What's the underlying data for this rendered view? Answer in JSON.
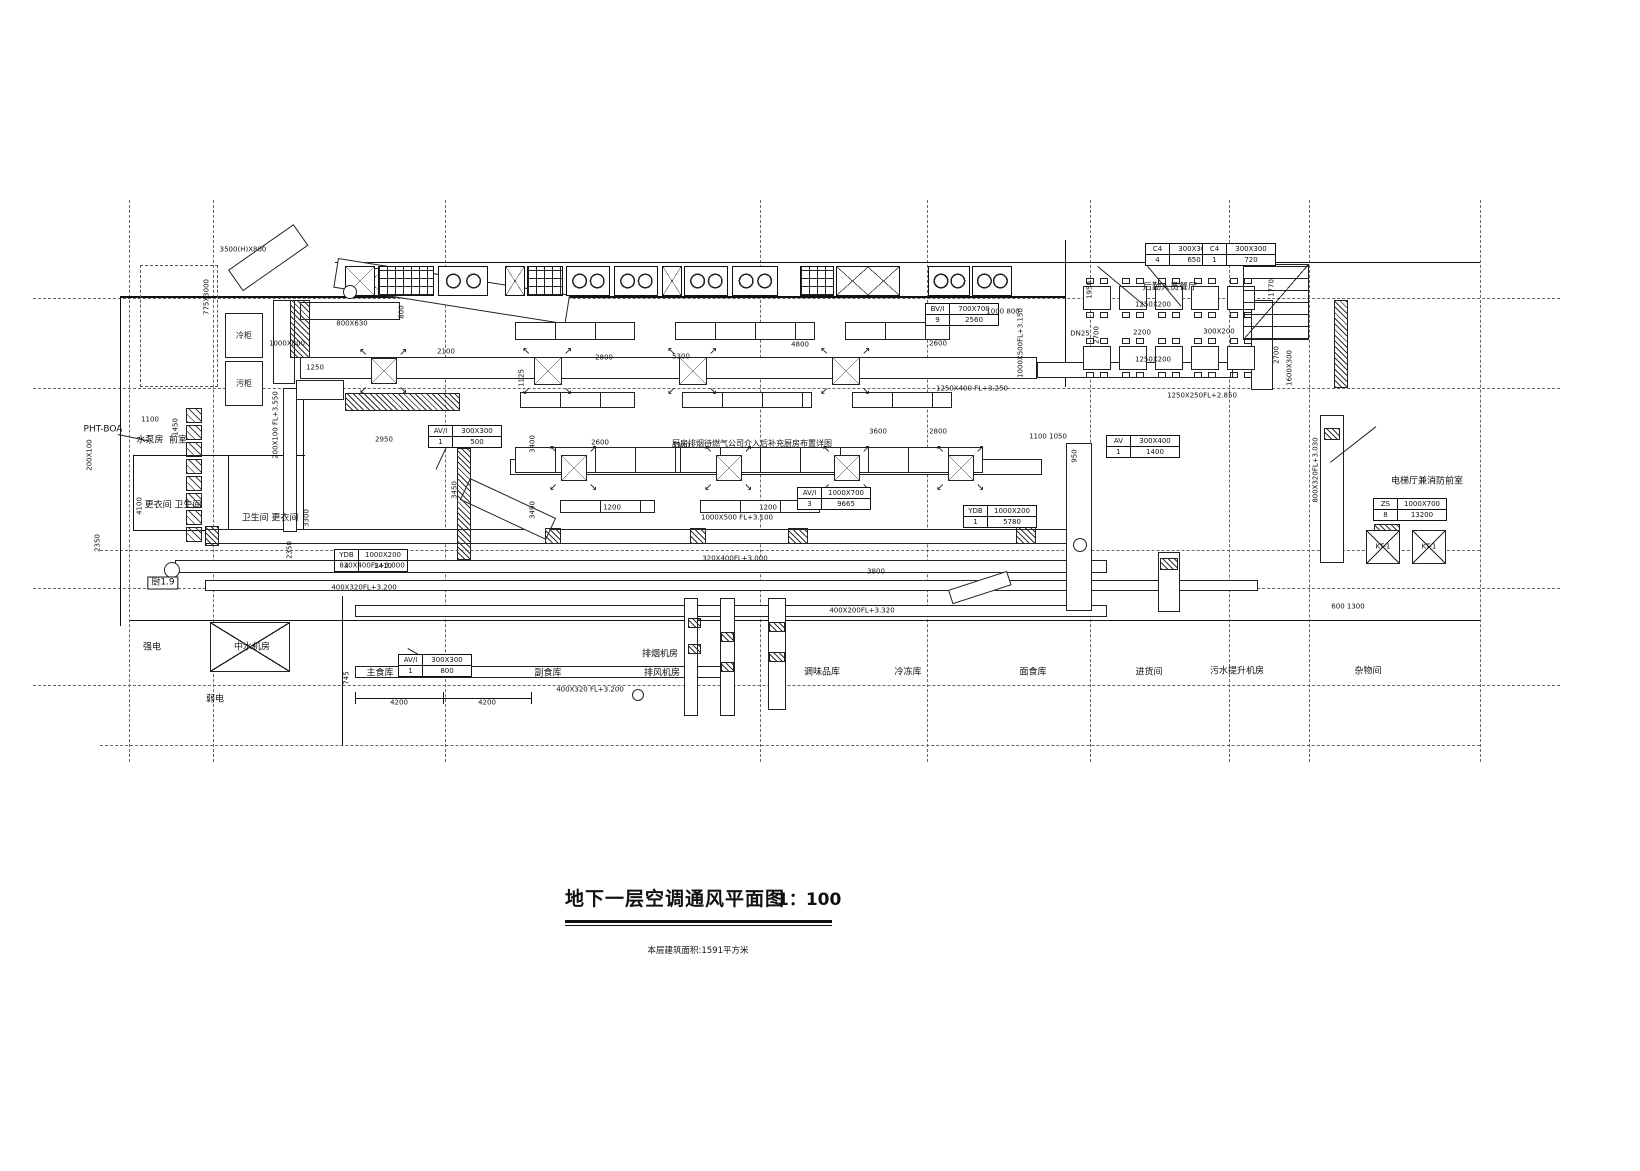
{
  "title_block": {
    "title": "地下一层空调通风平面图",
    "scale": "1：100",
    "note": "本层建筑面积:1591平方米"
  },
  "grid": {
    "v": [
      129,
      213,
      445,
      760,
      927,
      1090,
      1229,
      1309,
      1480
    ],
    "h": [
      {
        "y": 298,
        "x1": 33,
        "x2": 1560
      },
      {
        "y": 388,
        "x1": 33,
        "x2": 1560
      },
      {
        "y": 550,
        "x1": 100,
        "x2": 1480
      },
      {
        "y": 588,
        "x1": 33,
        "x2": 1560
      },
      {
        "y": 685,
        "x1": 33,
        "x2": 1560
      },
      {
        "y": 745,
        "x1": 100,
        "x2": 1480
      }
    ]
  },
  "walls": [
    {
      "x": 335,
      "y": 262,
      "w": 700,
      "h": 1
    },
    {
      "x": 1035,
      "y": 262,
      "w": 445,
      "h": 1
    },
    {
      "x": 1065,
      "y": 240,
      "w": 1,
      "h": 147
    },
    {
      "x": 120,
      "y": 296,
      "w": 945,
      "h": 2
    },
    {
      "x": 120,
      "y": 296,
      "w": 1,
      "h": 330
    },
    {
      "x": 130,
      "y": 620,
      "w": 1350,
      "h": 1
    },
    {
      "x": 342,
      "y": 596,
      "w": 1,
      "h": 149
    },
    {
      "x": 133,
      "y": 455,
      "w": 172,
      "h": 1
    },
    {
      "x": 133,
      "y": 530,
      "w": 172,
      "h": 1
    },
    {
      "x": 133,
      "y": 455,
      "w": 1,
      "h": 76
    },
    {
      "x": 228,
      "y": 455,
      "w": 1,
      "h": 76
    },
    {
      "x": 303,
      "y": 390,
      "w": 1,
      "h": 141
    },
    {
      "x": 355,
      "y": 698,
      "w": 176,
      "h": 1
    },
    {
      "x": 355,
      "y": 692,
      "w": 1,
      "h": 12
    },
    {
      "x": 443,
      "y": 692,
      "w": 1,
      "h": 12
    },
    {
      "x": 531,
      "y": 692,
      "w": 1,
      "h": 12
    }
  ],
  "ducts": {
    "h": [
      {
        "x": 300,
        "y": 357,
        "w": 737,
        "h": 22
      },
      {
        "x": 1037,
        "y": 362,
        "w": 196,
        "h": 16
      },
      {
        "x": 510,
        "y": 459,
        "w": 532,
        "h": 16
      },
      {
        "x": 205,
        "y": 529,
        "w": 872,
        "h": 15
      },
      {
        "x": 175,
        "y": 560,
        "w": 932,
        "h": 13
      },
      {
        "x": 205,
        "y": 580,
        "w": 1053,
        "h": 11
      },
      {
        "x": 355,
        "y": 605,
        "w": 752,
        "h": 12
      },
      {
        "x": 355,
        "y": 666,
        "w": 376,
        "h": 12
      },
      {
        "x": 296,
        "y": 380,
        "w": 48,
        "h": 20
      },
      {
        "x": 300,
        "y": 302,
        "w": 100,
        "h": 18
      }
    ],
    "v": [
      {
        "x": 273,
        "y": 300,
        "w": 22,
        "h": 84
      },
      {
        "x": 1066,
        "y": 443,
        "w": 26,
        "h": 168
      },
      {
        "x": 1320,
        "y": 415,
        "w": 24,
        "h": 148
      },
      {
        "x": 684,
        "y": 598,
        "w": 14,
        "h": 118
      },
      {
        "x": 720,
        "y": 598,
        "w": 15,
        "h": 118
      },
      {
        "x": 768,
        "y": 598,
        "w": 18,
        "h": 112
      },
      {
        "x": 1158,
        "y": 552,
        "w": 22,
        "h": 60
      },
      {
        "x": 1251,
        "y": 300,
        "w": 22,
        "h": 90
      },
      {
        "x": 283,
        "y": 388,
        "w": 14,
        "h": 144
      }
    ],
    "diag": [
      {
        "x": 338,
        "y": 258,
        "w": 235,
        "h": 30,
        "rot": 9
      },
      {
        "x": 470,
        "y": 478,
        "w": 95,
        "h": 24,
        "rot": 25
      },
      {
        "x": 948,
        "y": 590,
        "w": 62,
        "h": 15,
        "rot": -18
      },
      {
        "x": 228,
        "y": 270,
        "w": 80,
        "h": 26,
        "rot": -35
      }
    ]
  },
  "fixtures": {
    "hatches": [
      {
        "x": 545,
        "y": 528,
        "w": 16,
        "h": 16
      },
      {
        "x": 690,
        "y": 528,
        "w": 16,
        "h": 16
      },
      {
        "x": 788,
        "y": 528,
        "w": 20,
        "h": 16
      },
      {
        "x": 1016,
        "y": 524,
        "w": 20,
        "h": 20
      },
      {
        "x": 205,
        "y": 526,
        "w": 14,
        "h": 20
      },
      {
        "x": 688,
        "y": 618,
        "w": 13,
        "h": 10
      },
      {
        "x": 688,
        "y": 644,
        "w": 13,
        "h": 10
      },
      {
        "x": 721,
        "y": 632,
        "w": 13,
        "h": 10
      },
      {
        "x": 721,
        "y": 662,
        "w": 13,
        "h": 10
      },
      {
        "x": 769,
        "y": 622,
        "w": 16,
        "h": 10
      },
      {
        "x": 769,
        "y": 652,
        "w": 16,
        "h": 10
      },
      {
        "x": 290,
        "y": 300,
        "w": 20,
        "h": 58
      },
      {
        "x": 457,
        "y": 448,
        "w": 14,
        "h": 112
      },
      {
        "x": 1324,
        "y": 428,
        "w": 16,
        "h": 12
      },
      {
        "x": 1160,
        "y": 558,
        "w": 18,
        "h": 12
      },
      {
        "x": 1334,
        "y": 300,
        "w": 14,
        "h": 88
      },
      {
        "x": 345,
        "y": 393,
        "w": 115,
        "h": 18
      },
      {
        "x": 1374,
        "y": 524,
        "w": 26,
        "h": 9
      }
    ],
    "xboxes": [
      {
        "x": 210,
        "y": 622,
        "w": 80,
        "h": 50
      },
      {
        "x": 355,
        "y": 268,
        "w": 30,
        "h": 28
      }
    ],
    "kt_units": [
      {
        "x": 1366,
        "y": 530,
        "w": 34,
        "h": 34,
        "label": "KT-1"
      },
      {
        "x": 1412,
        "y": 530,
        "w": 34,
        "h": 34,
        "label": "KT-1"
      }
    ],
    "diffusers": [
      {
        "x": 371,
        "y": 358,
        "s": 26
      },
      {
        "x": 534,
        "y": 357,
        "s": 28
      },
      {
        "x": 679,
        "y": 357,
        "s": 28
      },
      {
        "x": 832,
        "y": 357,
        "s": 28
      },
      {
        "x": 561,
        "y": 455,
        "s": 26
      },
      {
        "x": 716,
        "y": 455,
        "s": 26
      },
      {
        "x": 834,
        "y": 455,
        "s": 26
      },
      {
        "x": 948,
        "y": 455,
        "s": 26
      }
    ],
    "kitchen_row": {
      "y": 266,
      "h": 30,
      "units": [
        {
          "t": "x",
          "x": 345,
          "w": 30
        },
        {
          "t": "g",
          "x": 378,
          "w": 56
        },
        {
          "t": "s",
          "x": 438,
          "w": 50
        },
        {
          "t": "x",
          "x": 505,
          "w": 20
        },
        {
          "t": "g",
          "x": 527,
          "w": 36
        },
        {
          "t": "s",
          "x": 566,
          "w": 44
        },
        {
          "t": "s",
          "x": 614,
          "w": 44
        },
        {
          "t": "x",
          "x": 662,
          "w": 20
        },
        {
          "t": "s",
          "x": 684,
          "w": 44
        },
        {
          "t": "s",
          "x": 732,
          "w": 46
        },
        {
          "t": "g",
          "x": 800,
          "w": 34
        },
        {
          "t": "xx",
          "x": 836,
          "w": 64
        },
        {
          "t": "s",
          "x": 928,
          "w": 42
        },
        {
          "t": "s",
          "x": 972,
          "w": 40
        }
      ]
    },
    "benches": [
      {
        "x": 515,
        "y": 322,
        "w": 120,
        "h": 18
      },
      {
        "x": 675,
        "y": 322,
        "w": 140,
        "h": 18
      },
      {
        "x": 845,
        "y": 322,
        "w": 105,
        "h": 18
      },
      {
        "x": 520,
        "y": 392,
        "w": 115,
        "h": 16
      },
      {
        "x": 682,
        "y": 392,
        "w": 130,
        "h": 16
      },
      {
        "x": 852,
        "y": 392,
        "w": 100,
        "h": 16
      },
      {
        "x": 515,
        "y": 447,
        "w": 170,
        "h": 26
      },
      {
        "x": 680,
        "y": 447,
        "w": 210,
        "h": 26
      },
      {
        "x": 868,
        "y": 447,
        "w": 115,
        "h": 26
      },
      {
        "x": 560,
        "y": 500,
        "w": 95,
        "h": 13
      },
      {
        "x": 700,
        "y": 500,
        "w": 120,
        "h": 13
      }
    ],
    "shaft_col": {
      "x": 186,
      "y": 408,
      "count": 8,
      "w": 16,
      "h": 15,
      "gap": 2
    },
    "tables": {
      "x0": 1083,
      "dx": 36,
      "w": 28,
      "h": 24,
      "rows": [
        286,
        346
      ],
      "count": 5
    },
    "stairs": {
      "x": 1243,
      "y": 264,
      "w": 66,
      "h": 76
    },
    "circles": [
      {
        "cx": 172,
        "cy": 570,
        "r": 8
      },
      {
        "cx": 350,
        "cy": 292,
        "r": 7
      },
      {
        "cx": 638,
        "cy": 695,
        "r": 6
      },
      {
        "cx": 1080,
        "cy": 545,
        "r": 7
      }
    ],
    "dashed_rects": [
      {
        "x": 140,
        "y": 265,
        "w": 78,
        "h": 122
      }
    ],
    "cold_boxes": [
      {
        "x": 225,
        "y": 313,
        "w": 38,
        "h": 45,
        "label": "冷柜"
      },
      {
        "x": 225,
        "y": 361,
        "w": 38,
        "h": 45,
        "label": "污柜"
      }
    ]
  },
  "tags": [
    {
      "x": 1145,
      "y": 243,
      "rows": [
        [
          "C4",
          "300X300"
        ],
        [
          "4",
          "650"
        ]
      ]
    },
    {
      "x": 1202,
      "y": 243,
      "rows": [
        [
          "C4",
          "300X300"
        ],
        [
          "1",
          "720"
        ]
      ]
    },
    {
      "x": 925,
      "y": 303,
      "rows": [
        [
          "BV/I",
          "700X700"
        ],
        [
          "9",
          "2560"
        ]
      ]
    },
    {
      "x": 428,
      "y": 425,
      "rows": [
        [
          "AV/I",
          "300X300"
        ],
        [
          "1",
          "500"
        ]
      ]
    },
    {
      "x": 334,
      "y": 549,
      "rows": [
        [
          "YDB",
          "1000X200"
        ],
        [
          "4",
          "3410"
        ]
      ]
    },
    {
      "x": 797,
      "y": 487,
      "rows": [
        [
          "AV/I",
          "1000X700"
        ],
        [
          "3",
          "9665"
        ]
      ]
    },
    {
      "x": 963,
      "y": 505,
      "rows": [
        [
          "YDB",
          "1000X200"
        ],
        [
          "1",
          "5780"
        ]
      ]
    },
    {
      "x": 1106,
      "y": 435,
      "rows": [
        [
          "AV",
          "300X400"
        ],
        [
          "1",
          "1400"
        ]
      ]
    },
    {
      "x": 398,
      "y": 654,
      "rows": [
        [
          "AV/I",
          "300X300"
        ],
        [
          "1",
          "800"
        ]
      ]
    },
    {
      "x": 1373,
      "y": 498,
      "rows": [
        [
          "ZS",
          "1000X700"
        ],
        [
          "8",
          "13200"
        ]
      ]
    }
  ],
  "labels": {
    "rooms": [
      {
        "t": "主食库",
        "x": 380,
        "y": 674
      },
      {
        "t": "副食库",
        "x": 548,
        "y": 674
      },
      {
        "t": "排烟机房",
        "x": 660,
        "y": 655
      },
      {
        "t": "排风机房",
        "x": 662,
        "y": 674
      },
      {
        "t": "调味品库",
        "x": 822,
        "y": 673
      },
      {
        "t": "冷冻库",
        "x": 908,
        "y": 673
      },
      {
        "t": "面食库",
        "x": 1033,
        "y": 673
      },
      {
        "t": "进货间",
        "x": 1149,
        "y": 673
      },
      {
        "t": "污水提升机房",
        "x": 1237,
        "y": 672
      },
      {
        "t": "杂物间",
        "x": 1368,
        "y": 672
      },
      {
        "t": "后勤人员餐厅",
        "x": 1170,
        "y": 288
      },
      {
        "t": "电梯厅兼消防前室",
        "x": 1427,
        "y": 482
      },
      {
        "t": "更衣间 卫生间",
        "x": 173,
        "y": 506
      },
      {
        "t": "卫生间 更衣间",
        "x": 270,
        "y": 519
      },
      {
        "t": "水泵房",
        "x": 150,
        "y": 441
      },
      {
        "t": "前室",
        "x": 178,
        "y": 441
      },
      {
        "t": "强电",
        "x": 152,
        "y": 648
      },
      {
        "t": "中水机房",
        "x": 252,
        "y": 648
      },
      {
        "t": "弱电",
        "x": 215,
        "y": 700
      },
      {
        "t": "PHT-BOA",
        "x": 103,
        "y": 430
      },
      {
        "t": "厨1.9",
        "x": 163,
        "y": 583,
        "boxed": true
      }
    ],
    "ducts": [
      {
        "t": "3500(H)X800",
        "x": 243,
        "y": 250
      },
      {
        "t": "800X630",
        "x": 352,
        "y": 324
      },
      {
        "t": "1000X800",
        "x": 287,
        "y": 344
      },
      {
        "t": "1250X400 FL+3.250",
        "x": 972,
        "y": 389
      },
      {
        "t": "1250X250FL+2.850",
        "x": 1202,
        "y": 396
      },
      {
        "t": "1250X200",
        "x": 1153,
        "y": 305
      },
      {
        "t": "1250X200",
        "x": 1153,
        "y": 360
      },
      {
        "t": "300X200",
        "x": 1219,
        "y": 332
      },
      {
        "t": "DN25",
        "x": 1080,
        "y": 334
      },
      {
        "t": "2200",
        "x": 1142,
        "y": 333
      },
      {
        "t": "830X400FL+3.000",
        "x": 372,
        "y": 566
      },
      {
        "t": "400X320FL+3.200",
        "x": 364,
        "y": 588
      },
      {
        "t": "400X200FL+3.320",
        "x": 862,
        "y": 611
      },
      {
        "t": "3800",
        "x": 876,
        "y": 572
      },
      {
        "t": "1000X500 FL+3.100",
        "x": 737,
        "y": 518
      },
      {
        "t": "320X400FL+3.000",
        "x": 735,
        "y": 559
      },
      {
        "t": "400X320 FL+3.200",
        "x": 590,
        "y": 690
      },
      {
        "t": "600  1300",
        "x": 1348,
        "y": 607
      }
    ],
    "dims": [
      {
        "t": "2100",
        "x": 446,
        "y": 352
      },
      {
        "t": "2800",
        "x": 604,
        "y": 358
      },
      {
        "t": "5300",
        "x": 681,
        "y": 357
      },
      {
        "t": "4800",
        "x": 800,
        "y": 345
      },
      {
        "t": "2600",
        "x": 938,
        "y": 344
      },
      {
        "t": "1250",
        "x": 315,
        "y": 368
      },
      {
        "t": "2950",
        "x": 384,
        "y": 440
      },
      {
        "t": "2600",
        "x": 600,
        "y": 443
      },
      {
        "t": "5300",
        "x": 681,
        "y": 446
      },
      {
        "t": "3600",
        "x": 878,
        "y": 432
      },
      {
        "t": "2800",
        "x": 938,
        "y": 432
      },
      {
        "t": "1100  1050",
        "x": 1048,
        "y": 437
      },
      {
        "t": "1200",
        "x": 612,
        "y": 508
      },
      {
        "t": "1200",
        "x": 768,
        "y": 508
      },
      {
        "t": "1000  800",
        "x": 1003,
        "y": 312
      },
      {
        "t": "4200",
        "x": 399,
        "y": 703
      },
      {
        "t": "4200",
        "x": 487,
        "y": 703
      },
      {
        "t": "1100",
        "x": 150,
        "y": 420
      }
    ],
    "dims_rot": [
      {
        "t": "800",
        "x": 402,
        "y": 312
      },
      {
        "t": "1950",
        "x": 1090,
        "y": 290
      },
      {
        "t": "2700",
        "x": 1097,
        "y": 335
      },
      {
        "t": "1770",
        "x": 1272,
        "y": 288
      },
      {
        "t": "2700",
        "x": 1277,
        "y": 355
      },
      {
        "t": "3400",
        "x": 533,
        "y": 444
      },
      {
        "t": "3490",
        "x": 533,
        "y": 510
      },
      {
        "t": "1125",
        "x": 522,
        "y": 378
      },
      {
        "t": "3450",
        "x": 455,
        "y": 490
      },
      {
        "t": "2350",
        "x": 98,
        "y": 543
      },
      {
        "t": "2350",
        "x": 290,
        "y": 550
      },
      {
        "t": "4100",
        "x": 140,
        "y": 506
      },
      {
        "t": "3300",
        "x": 307,
        "y": 518
      },
      {
        "t": "1450",
        "x": 176,
        "y": 427
      },
      {
        "t": "745",
        "x": 347,
        "y": 678
      },
      {
        "t": "950",
        "x": 1075,
        "y": 456
      },
      {
        "t": "775X3000",
        "x": 207,
        "y": 297
      },
      {
        "t": "200X100 FL+3.550",
        "x": 276,
        "y": 425
      },
      {
        "t": "1000X500FL+3.150",
        "x": 1021,
        "y": 343
      },
      {
        "t": "800X320FL+3.030",
        "x": 1316,
        "y": 470
      },
      {
        "t": "1600X300",
        "x": 1290,
        "y": 368
      },
      {
        "t": "200X100",
        "x": 90,
        "y": 455
      }
    ],
    "note": {
      "t": "厨房排烟待燃气公司介入后补充厨房布置详图",
      "x": 752,
      "y": 444
    }
  },
  "leaders": [
    {
      "x": 1098,
      "y": 266,
      "w": 62,
      "rot": 40
    },
    {
      "x": 1148,
      "y": 266,
      "w": 52,
      "rot": 50
    },
    {
      "x": 1330,
      "y": 462,
      "w": 58,
      "rot": -38
    },
    {
      "x": 408,
      "y": 648,
      "w": 32,
      "rot": 30
    },
    {
      "x": 118,
      "y": 434,
      "w": 32,
      "rot": 12
    },
    {
      "x": 447,
      "y": 447,
      "w": 25,
      "rot": 115
    }
  ]
}
